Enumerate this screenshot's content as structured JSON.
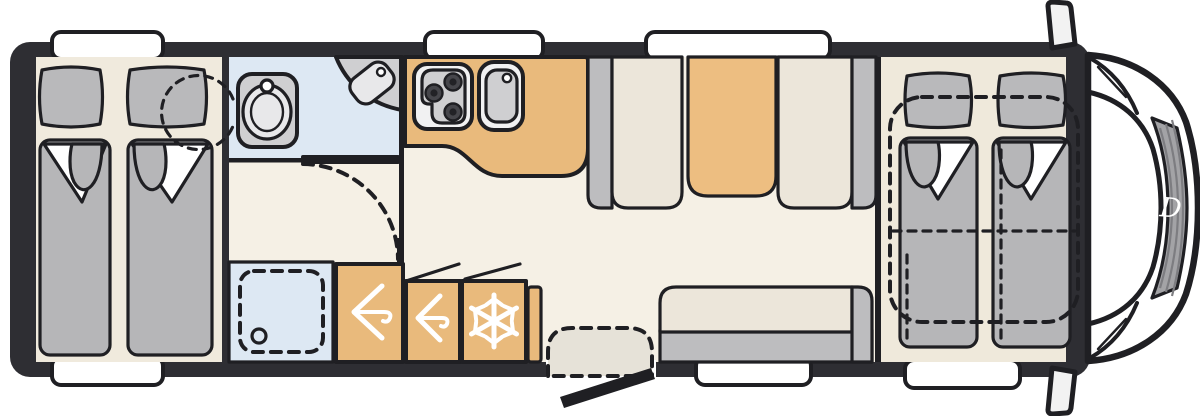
{
  "title": "motorhome-floor-plan",
  "cab": {
    "logo_letter": "D"
  },
  "rooms": {
    "rear_bedroom": "twin-single-beds",
    "bathroom": "toilet-and-corner-washbasin",
    "shower": "shower-cubicle",
    "wardrobes": "two-hanging-wardrobes",
    "fridge": "refrigerator",
    "kitchen": "hob-and-sink-counter",
    "dinette": "face-to-face-seats-with-table",
    "bench": "side-bench-sofa",
    "front_bedroom": "drop-down-double-bed-over-cab"
  },
  "colors": {
    "wall": "#2e2e33",
    "outline": "#1f1f23",
    "floor": "#f5f0e5",
    "floor_rear": "#f0eadd",
    "floor_front": "#efe9db",
    "bath": "#dde8f3",
    "cabinet": "#e9ba7c",
    "table": "#edbe81",
    "soft_gray": "#bdbdbf",
    "cushion": "#ece6da",
    "fixture_gray": "#cfcfd1",
    "fixture_light": "#e8e8ea",
    "pillow": "#b9b9bb",
    "duvet": "#b6b6b8",
    "burner": "#46464b",
    "burner_core": "#222226",
    "step": "#e6e2d8",
    "white": "#ffffff",
    "grille": "#a3a3a6",
    "grille_rib": "#7d7d81",
    "mirror": "#f2f2f2",
    "hob_face": "#f1f1f2"
  }
}
